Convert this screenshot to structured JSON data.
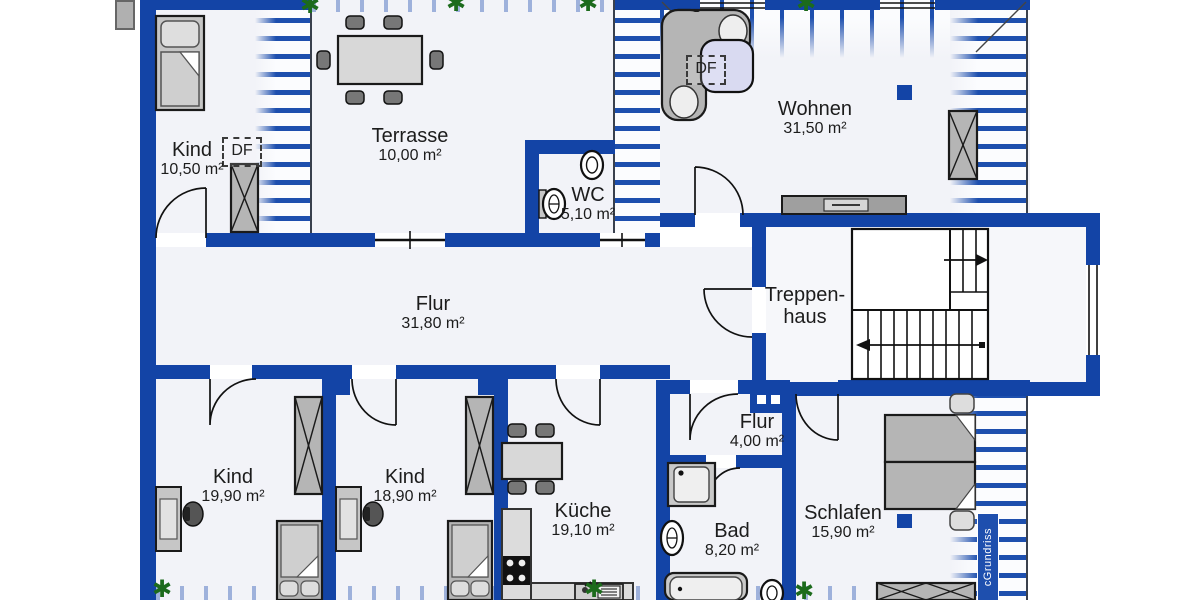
{
  "watermark": "cGrundriss",
  "annotations": {
    "df_label": "DF"
  },
  "rooms": {
    "kind1": {
      "label": "Kind",
      "area": "10,50 m²"
    },
    "terrasse": {
      "label": "Terrasse",
      "area": "10,00 m²"
    },
    "wc": {
      "label": "WC",
      "area": "5,10 m²"
    },
    "wohnen": {
      "label": "Wohnen",
      "area": "31,50 m²"
    },
    "flur": {
      "label": "Flur",
      "area": "31,80 m²"
    },
    "treppenhaus": {
      "label_line1": "Treppen-",
      "label_line2": "haus"
    },
    "kind2": {
      "label": "Kind",
      "area": "19,90 m²"
    },
    "kind3": {
      "label": "Kind",
      "area": "18,90 m²"
    },
    "kueche": {
      "label": "Küche",
      "area": "19,10 m²"
    },
    "flur2": {
      "label": "Flur",
      "area": "4,00 m²"
    },
    "bad": {
      "label": "Bad",
      "area": "8,20 m²"
    },
    "schlafen": {
      "label": "Schlafen",
      "area": "15,90 m²"
    }
  },
  "colors": {
    "wall": "#1344a6",
    "hatch_stripe": "#1d4fae",
    "floor": "#f2f3f8",
    "plant_green": "#1c6b1c",
    "table_lavender": "#d9daf1"
  }
}
